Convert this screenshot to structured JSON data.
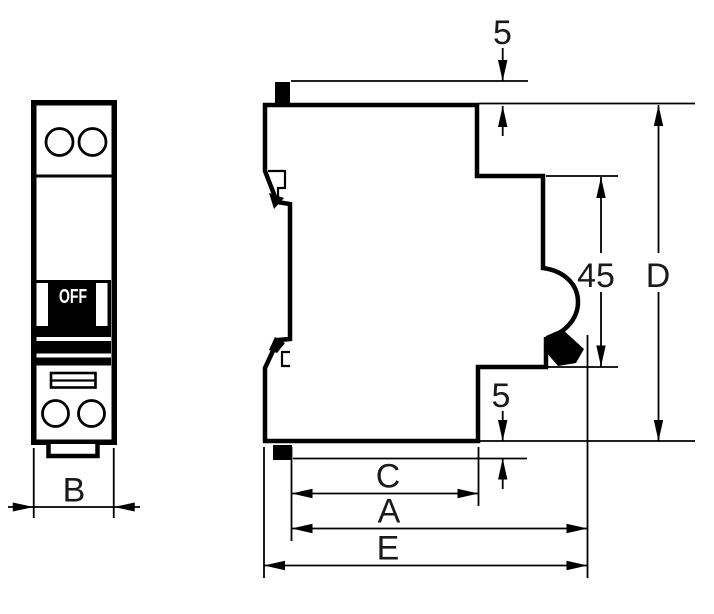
{
  "labels": {
    "b": "B",
    "top_clearance": "5",
    "bottom_clearance": "5",
    "handle_zone": "45",
    "overall_height": "D",
    "depth_c": "C",
    "depth_a": "A",
    "depth_e": "E"
  },
  "switch": {
    "state": "OFF"
  },
  "colors": {
    "line": "#000000",
    "background": "#ffffff",
    "label_text": "#1a1a1a",
    "switch_body": "#000000",
    "switch_text": "#ffffff"
  }
}
